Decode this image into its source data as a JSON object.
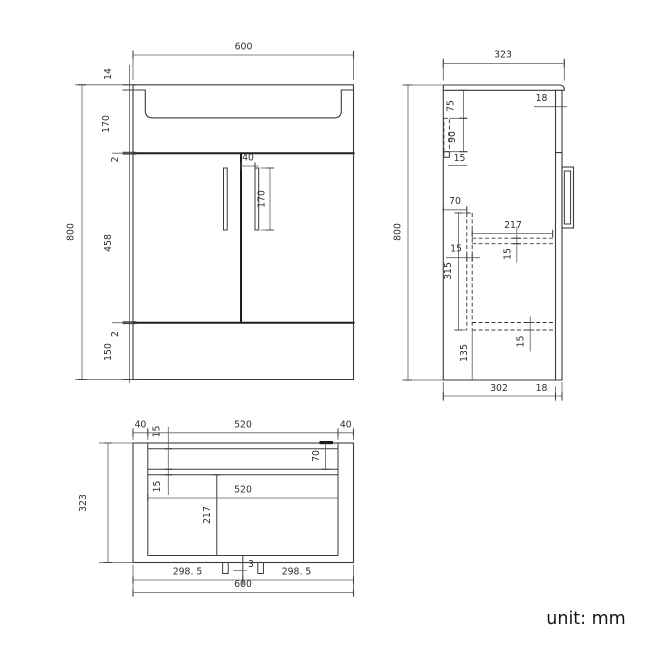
{
  "note": {
    "unit": "unit: mm"
  },
  "front": {
    "total_width": "600",
    "total_height": "800",
    "counter_thickness": "14",
    "basin_depth": "170",
    "top_gap": "2",
    "door_height": "458",
    "bottom_gap": "2",
    "plinth_height": "150",
    "handle_offset": "40",
    "handle_length": "170"
  },
  "side": {
    "total_depth": "323",
    "total_height": "800",
    "door_thickness": "18",
    "bracket_offset": "75",
    "bracket_height": "90",
    "bracket_plate": "15",
    "rail_depth": "70",
    "shelf_depth": "217",
    "panel_thickness": "15",
    "shelf_thickness": "15",
    "panel_height": "315",
    "bottom_thickness": "15",
    "plinth_recess": "135",
    "body_depth": "302",
    "front_thickness": "18"
  },
  "plan": {
    "left_panel": "40",
    "back_thickness": "15",
    "back_opening": "520",
    "right_panel": "40",
    "rail_depth": "70",
    "rail_thickness": "15",
    "opening_width": "520",
    "divider_depth": "217",
    "total_depth": "323",
    "left_door": "298. 5",
    "center_gap": "3",
    "right_door": "298. 5",
    "total_width": "600"
  }
}
